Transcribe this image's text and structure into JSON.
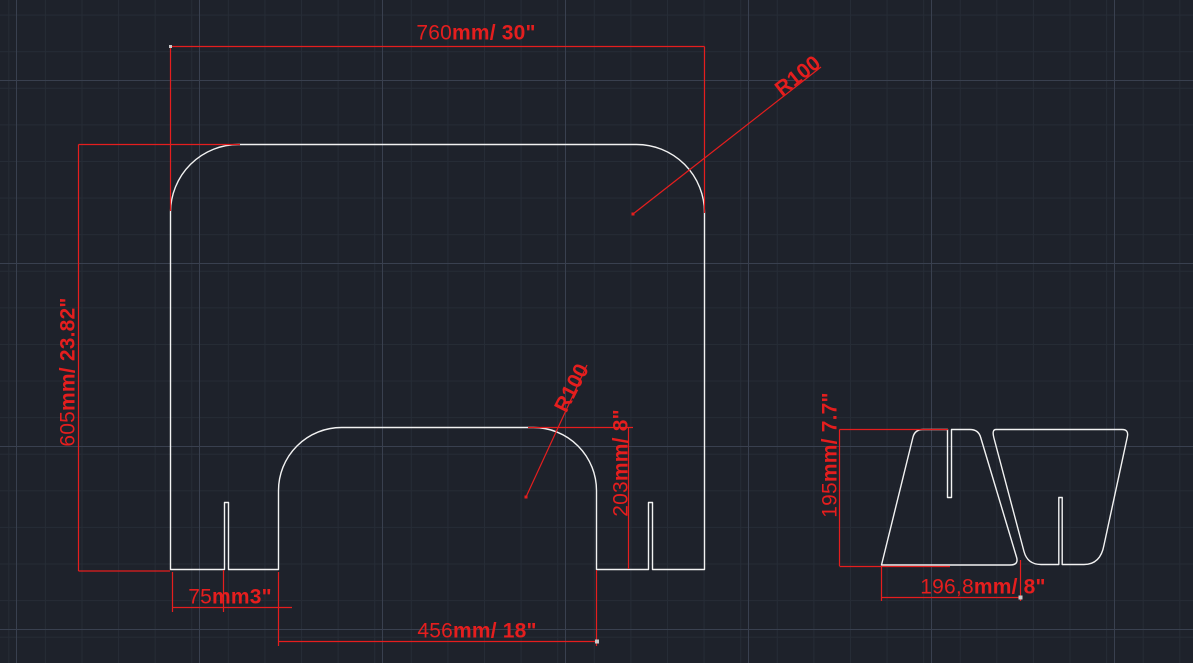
{
  "app": {
    "view_label": "cad-drawing-viewport"
  },
  "colors": {
    "background": "#1e222b",
    "grid_minor": "#262c36",
    "grid_major": "#39404f",
    "outline": "#f2f2f2",
    "dimension": "#e51e1e"
  },
  "dimensions": {
    "panel_width": {
      "value": "760",
      "unit": "mm/ 30\""
    },
    "panel_height": {
      "value": "605",
      "unit": "mm/ 23.82\""
    },
    "panel_corner_radius": "R100",
    "window_corner_radius": "R100",
    "window_height": {
      "value": "203",
      "unit": "mm/ 8\""
    },
    "slot_offset": {
      "value": "75",
      "unit": "mm3\""
    },
    "window_width": {
      "value": "456",
      "unit": "mm/ 18\""
    },
    "bracket_height": {
      "value": "195",
      "unit": "mm/ 7.7\""
    },
    "bracket_width": {
      "value": "196,8",
      "unit": "mm/ 8\""
    }
  }
}
